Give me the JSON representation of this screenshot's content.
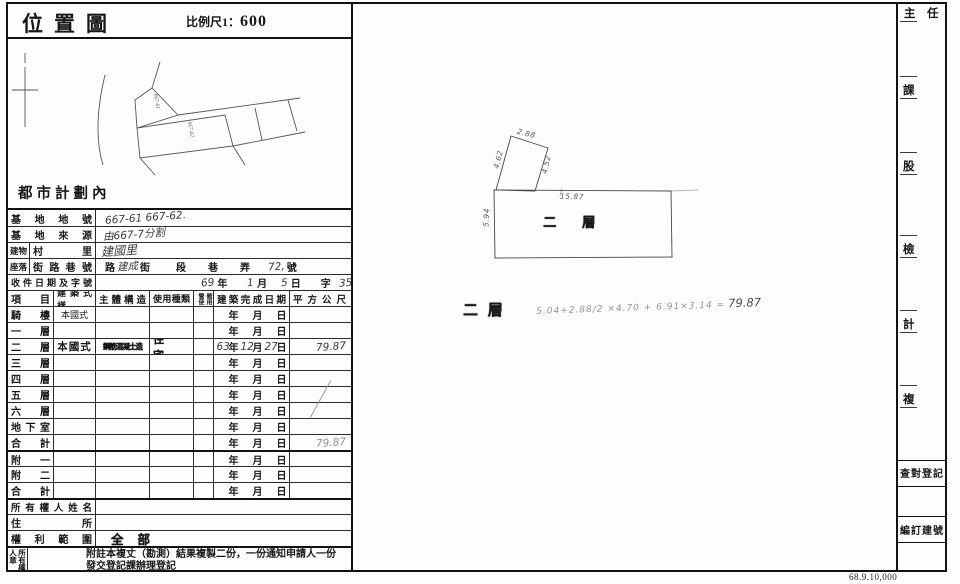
{
  "title": {
    "text": "位置圖",
    "scale_prefix": "比例尺1：",
    "scale_value": "600"
  },
  "sketch": {
    "note": "都市計劃內",
    "parcel1": "667-61",
    "parcel2": "667-62"
  },
  "upper": {
    "r1_label": "基地地號",
    "r1_value": "667-61 667-62.",
    "r2_label": "基地來源",
    "r2_value": "由667-7分割",
    "r3_outer": "建物",
    "r3_label": "村里",
    "r3_value": "建國里",
    "r4_outer": "座落",
    "r4_label": "街路巷號",
    "r4_units": {
      "road": "路",
      "street": "街",
      "section": "段",
      "lane": "巷",
      "alley": "弄",
      "number": "號"
    },
    "r4_hand": {
      "street_name": "建成",
      "house_no": "72,"
    },
    "r5_label": "收件日期及字號",
    "r5_units": {
      "year": "年",
      "month": "月",
      "day": "日",
      "char": "字",
      "number": "號"
    },
    "r5_hand": {
      "year": "69",
      "month": "1",
      "day": "5",
      "number": "356"
    }
  },
  "floors": {
    "headers": {
      "item": "項目",
      "style": "建築式樣",
      "structure": "主體構造",
      "use": "使用種類",
      "tiny1": "營使",
      "tiny2": "雜用",
      "date": "建築完成日期",
      "area": "平方公尺"
    },
    "units": {
      "year": "年",
      "month": "月",
      "day": "日"
    },
    "rows": [
      {
        "item": "騎樓",
        "style": "本國式",
        "structure": "",
        "use": "",
        "y": "",
        "m": "",
        "d": "",
        "area": ""
      },
      {
        "item": "一層",
        "style": "",
        "structure": "",
        "use": "",
        "y": "",
        "m": "",
        "d": "",
        "area": ""
      },
      {
        "item": "二層",
        "style": "本國式",
        "structure": "鋼筋混凝土造",
        "use": "住宅",
        "y": "63",
        "m": "12",
        "d": "27",
        "area": "79.87"
      },
      {
        "item": "三層",
        "style": "",
        "structure": "",
        "use": "",
        "y": "",
        "m": "",
        "d": "",
        "area": ""
      },
      {
        "item": "四層",
        "style": "",
        "structure": "",
        "use": "",
        "y": "",
        "m": "",
        "d": "",
        "area": ""
      },
      {
        "item": "五層",
        "style": "",
        "structure": "",
        "use": "",
        "y": "",
        "m": "",
        "d": "",
        "area": ""
      },
      {
        "item": "六層",
        "style": "",
        "structure": "",
        "use": "",
        "y": "",
        "m": "",
        "d": "",
        "area": ""
      },
      {
        "item": "地下室",
        "style": "",
        "structure": "",
        "use": "",
        "y": "",
        "m": "",
        "d": "",
        "area": ""
      },
      {
        "item": "合計",
        "style": "",
        "structure": "",
        "use": "",
        "y": "",
        "m": "",
        "d": "",
        "area": "79.87"
      },
      {
        "item": "附一",
        "style": "",
        "structure": "",
        "use": "",
        "y": "",
        "m": "",
        "d": "",
        "area": ""
      },
      {
        "item": "附二",
        "style": "",
        "structure": "",
        "use": "",
        "y": "",
        "m": "",
        "d": "",
        "area": ""
      },
      {
        "item": "合計",
        "style": "",
        "structure": "",
        "use": "",
        "y": "",
        "m": "",
        "d": "",
        "area": ""
      }
    ]
  },
  "owner": {
    "name_label": "所有權人姓名",
    "addr_label": "住所",
    "rights_label": "權利範圍",
    "rights_value": "全部",
    "seal_label": "所有權人章",
    "note": "附註本複丈（勘測）結果複製二份，一份通知申請人一份發交登記課辦理登記"
  },
  "plan": {
    "label_inside": "二　層",
    "label_below": "二 層",
    "formula": "5.04+2.88/2 ×4.70 + 6.91×3.14 =",
    "result": "79.87",
    "dims": {
      "d1": "2.88",
      "d2": "4.62",
      "d3": "4.52",
      "d4": "15.87",
      "d5": "5.94"
    }
  },
  "strip": {
    "h1": "主",
    "h2": "任",
    "c1": "課",
    "c2": "股",
    "c3": "檢",
    "c4": "計",
    "c5": "複",
    "box1": "查對登記",
    "box2": "編訂建號"
  },
  "print_code": "68.9.10,000"
}
